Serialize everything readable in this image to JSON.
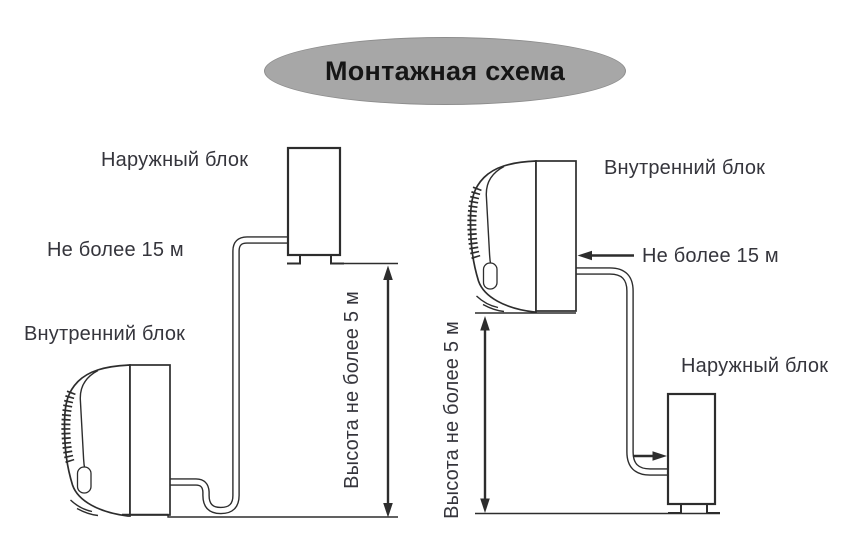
{
  "title": "Монтажная схема",
  "colors": {
    "background": "#ffffff",
    "line_color": "#2d2d2d",
    "label_color": "#35353c",
    "title_color": "#161616",
    "ellipse_fill": "#a7a7a7",
    "ellipse_border": "#8d8d8d"
  },
  "left_diagram": {
    "outdoor_unit_label": "Наружный блок",
    "pipe_length_label": "Не более 15 м",
    "indoor_unit_label": "Внутренний блок",
    "height_limit_label": "Высота не более 5 м"
  },
  "right_diagram": {
    "indoor_unit_label": "Внутренний блок",
    "pipe_length_label": "Не более 15 м",
    "outdoor_unit_label": "Наружный блок",
    "height_limit_label": "Высота не более 5 м"
  }
}
